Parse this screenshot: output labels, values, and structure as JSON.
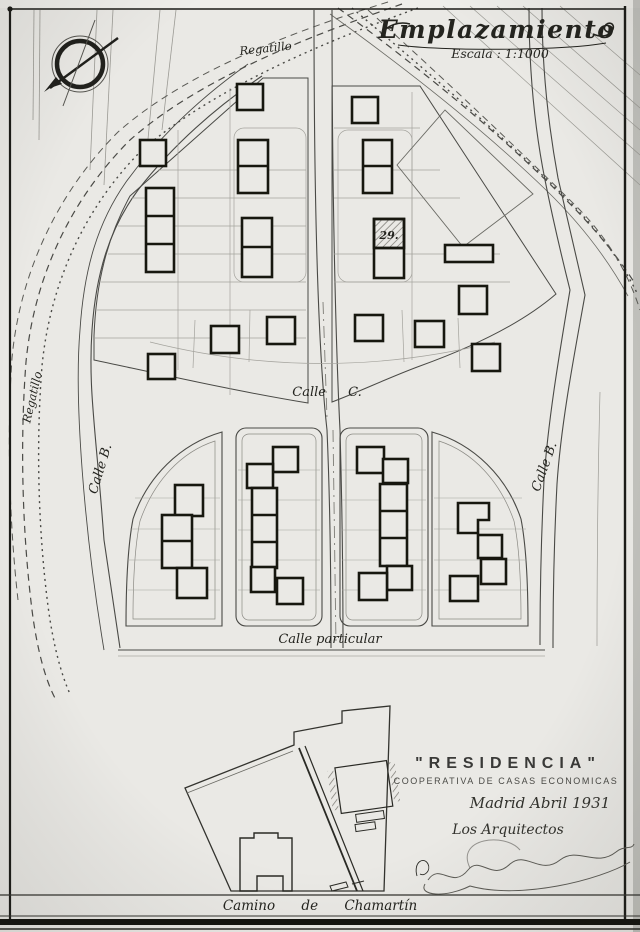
{
  "document": {
    "title": "Emplazamiento",
    "scale": "Escala : 1:1000",
    "plot_number": "29.",
    "labels": {
      "street_left": "Calle B.",
      "street_right": "Calle B.",
      "street_center": "Calle C.",
      "street_private": "Calle particular",
      "road_bottom": "Camino de Chamartín",
      "stream_top": "Regatillo",
      "stream_left": "Regatillo"
    },
    "title_block": {
      "project": "\"RESIDENCIA\"",
      "subtitle": "COOPERATIVA DE CASAS ECONOMICAS",
      "place_date": "Madrid Abril 1931",
      "signed_by": "Los Arquitectos"
    },
    "icons": {
      "compass": "north-arrow-icon"
    }
  }
}
